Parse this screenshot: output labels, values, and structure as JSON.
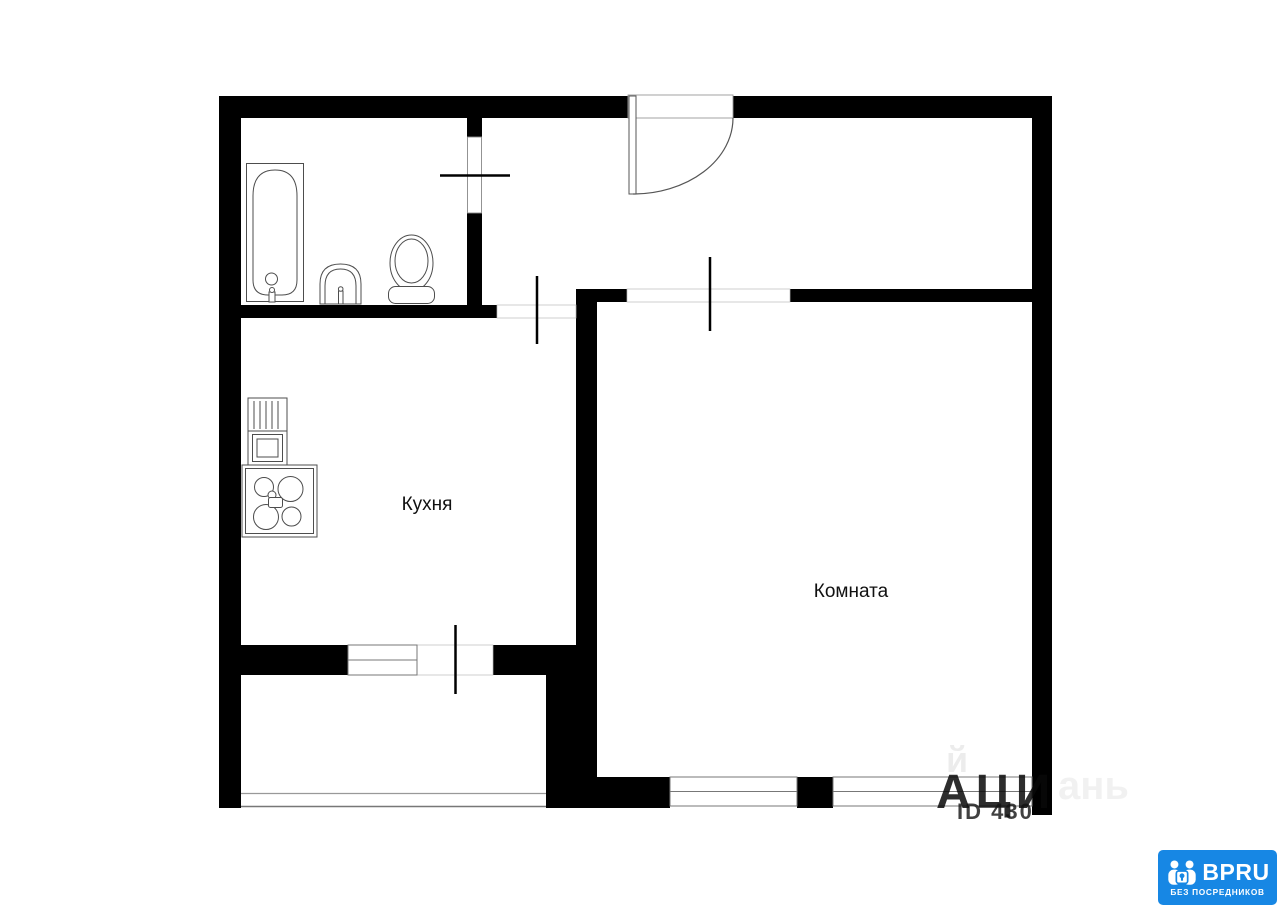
{
  "plan": {
    "kitchen_label": "Кухня",
    "room_label": "Комната"
  },
  "watermark": {
    "big_text": "АЦИ",
    "id_text": "ID 430",
    "faint_text": "ань",
    "faint_small": "й"
  },
  "logo": {
    "brand": "BPRU",
    "tagline": "БЕЗ ПОСРЕДНИКОВ"
  },
  "colors": {
    "background": "#ffffff",
    "wall": "#000000",
    "fixture_stroke": "#4d4d4d",
    "window_stroke": "#777777",
    "logo_background": "#1787e4",
    "logo_text": "#ffffff",
    "watermark_gray": "#141414"
  }
}
